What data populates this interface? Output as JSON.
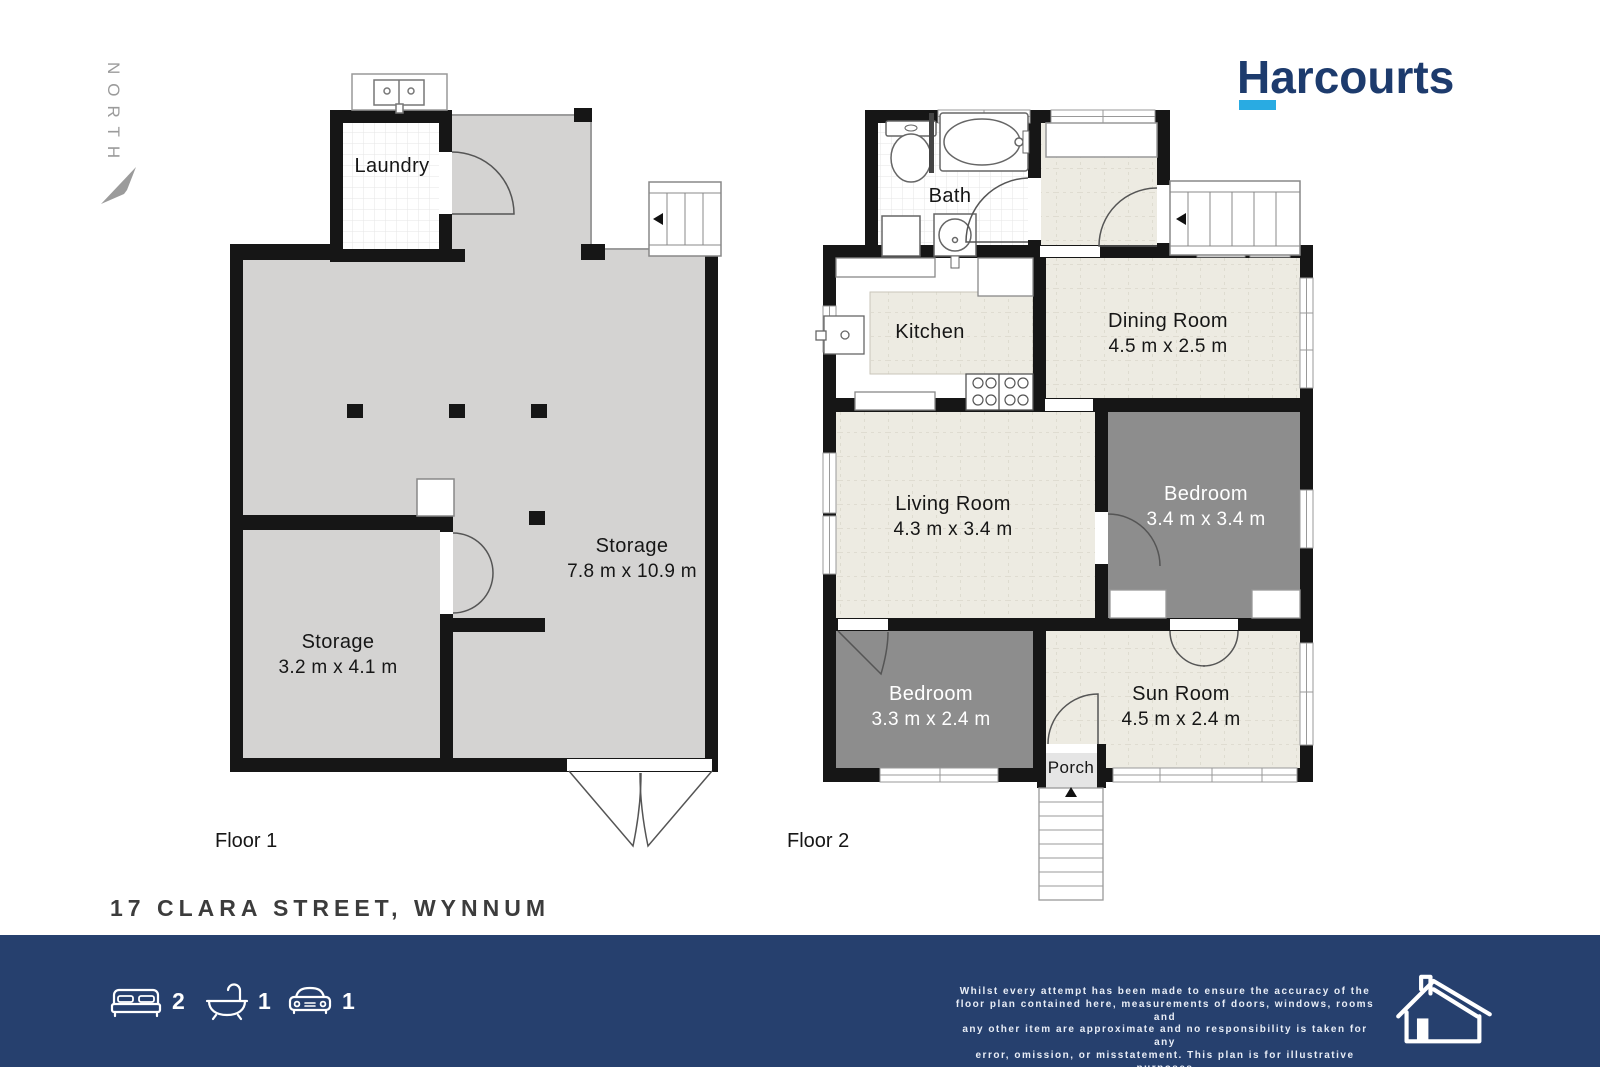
{
  "brand": {
    "name": "Harcourts",
    "navy": "#1d3b6d",
    "cyan": "#29abe2"
  },
  "compass": {
    "label": "NORTH"
  },
  "address": "17 CLARA STREET, WYNNUM",
  "floor1": {
    "label": "Floor 1",
    "rooms": {
      "laundry": {
        "name": "Laundry"
      },
      "storage_main": {
        "name": "Storage",
        "dims": "7.8 m x 10.9 m"
      },
      "storage_small": {
        "name": "Storage",
        "dims": "3.2 m x 4.1 m"
      }
    }
  },
  "floor2": {
    "label": "Floor 2",
    "rooms": {
      "bath": {
        "name": "Bath"
      },
      "kitchen": {
        "name": "Kitchen"
      },
      "dining": {
        "name": "Dining Room",
        "dims": "4.5 m x 2.5 m"
      },
      "living": {
        "name": "Living Room",
        "dims": "4.3 m x 3.4 m"
      },
      "bedroom_right": {
        "name": "Bedroom",
        "dims": "3.4 m x 3.4 m"
      },
      "bedroom_left": {
        "name": "Bedroom",
        "dims": "3.3 m x 2.4 m"
      },
      "sunroom": {
        "name": "Sun Room",
        "dims": "4.5 m x 2.4 m"
      },
      "porch": {
        "name": "Porch"
      }
    }
  },
  "footer": {
    "beds": "2",
    "baths": "1",
    "cars": "1",
    "bar_color": "#26406e",
    "disclaimer_lines": [
      "Whilst every attempt has been made to ensure the accuracy of the",
      "floor plan contained here, measurements of doors, windows, rooms and",
      "any other item are approximate and no responsibility is taken for any",
      "error, omission, or misstatement. This plan is for illustrative purposes",
      "only and should only be used as such by any prospective purchaser."
    ]
  }
}
